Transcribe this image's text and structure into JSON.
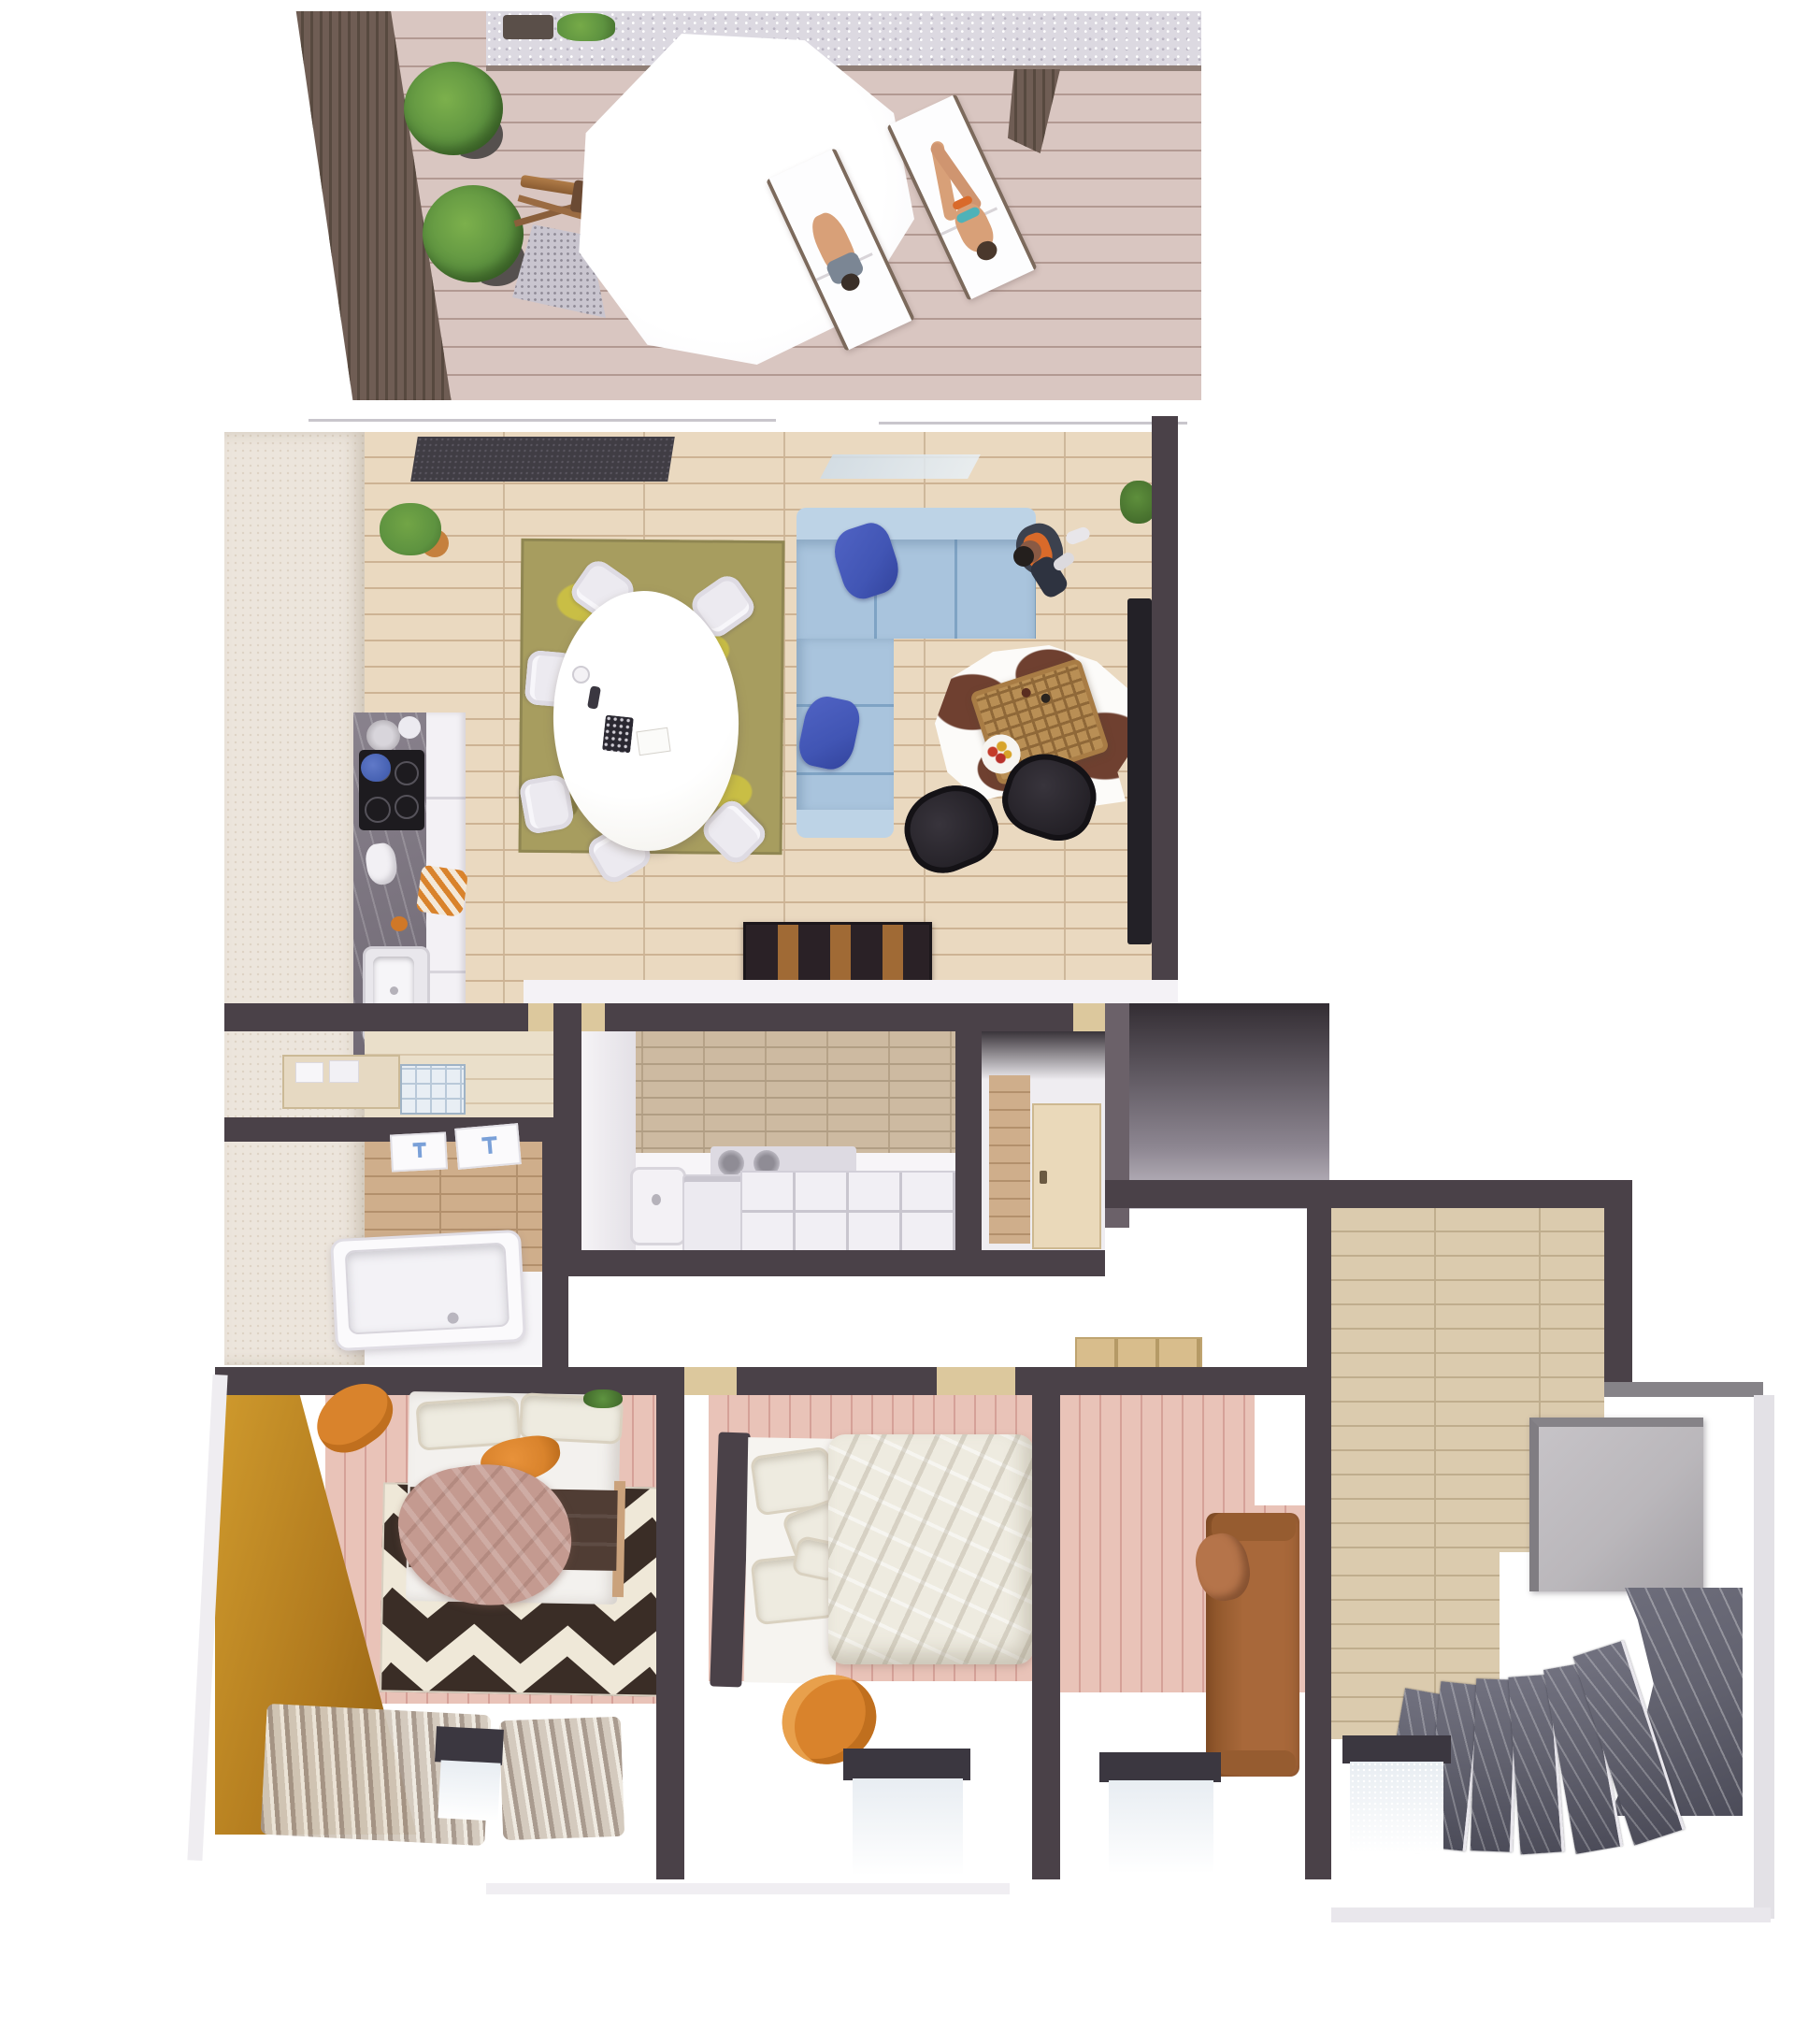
{
  "image_type": "3d-floor-plan-render",
  "view": "top-down dollhouse view, single apartment level, no visible text or labels",
  "scene": {
    "terrace": {
      "items": [
        "cantilever-umbrella",
        "sun-lounger-with-person",
        "sun-lounger-with-person",
        "topiary-plant",
        "topiary-plant",
        "hedge-planter",
        "gravel-border",
        "privacy-slat-wall",
        "wood-decking"
      ]
    },
    "living_room": {
      "items": [
        "doormat",
        "oval-dining-table",
        "dining-chairs-x6",
        "olive-area-rug",
        "potted-plant",
        "l-shaped-sofa",
        "blue-cushions-x2",
        "standing-person",
        "cowhide-rug",
        "wicker-coffee-table",
        "fruit-bowl",
        "black-lounge-chair-x2",
        "wall-tv",
        "low-bookshelf",
        "small-plant"
      ]
    },
    "kitchen": {
      "items": [
        "marble-counter",
        "cooktop",
        "sink",
        "checkered-towel",
        "dishes",
        "blue-pot"
      ]
    },
    "laundry_room": {
      "items": [
        "wash-basin",
        "washing-machine",
        "storage-cubbies",
        "counter",
        "closet-door"
      ]
    },
    "bathroom": {
      "items": [
        "bathtub",
        "towel-radiator",
        "towel-radiator",
        "wood-tile-wall"
      ]
    },
    "bedroom_left": {
      "items": [
        "double-bed",
        "pillows",
        "mauve-blanket",
        "orange-garment",
        "chevron-rug",
        "orange-armchair",
        "amber-wardrobe",
        "curtains",
        "window"
      ]
    },
    "bedroom_middle": {
      "items": [
        "double-bed-dark-headboard",
        "cream-duvet",
        "pillows-x4",
        "orange-armchair",
        "window"
      ]
    },
    "bedroom_right": {
      "items": [
        "leather-daybed",
        "cushion",
        "window",
        "doorway"
      ]
    },
    "entry_hall": {
      "items": [
        "wood-plank-floor",
        "gray-landing-pad",
        "closet-void"
      ]
    },
    "staircase": {
      "items": [
        "curved-marble-steps-x6",
        "marble-landing",
        "window"
      ]
    }
  },
  "palette": {
    "wall": "#4a4148",
    "wall-light": "#6b6169",
    "deck": "#d9c6c1",
    "deck-line": "#b29992",
    "slat": "#6f5d54",
    "slat-dark": "#57493f",
    "gravel": "#dcd9e1",
    "floor-living": "#ead9c0",
    "floor-living-line": "#cdb394",
    "tile-wood": "#cdbaa1",
    "tile-wood-line": "#b19e84",
    "bath-wood": "#cfae8b",
    "bath-wood-line": "#b3906c",
    "floor-pink": "#e9c3b8",
    "floor-pink-line": "#d5a198",
    "floor-hall": "#dbcbae",
    "floor-hall-line": "#bfad8d",
    "rug-olive": "#a79d5f",
    "rug-olive-spot": "#c9be45",
    "rug-olive-dark": "#857c42",
    "sofa": "#a9c4dd",
    "sofa-light": "#bdd3e6",
    "sofa-seam": "#7fa3c4",
    "pillow-blue": "#4155b4",
    "cowhide": "#6f4030",
    "wicker": "#b98f55",
    "wicker-line": "#8f6838",
    "chair-black": "#232026",
    "shelf-wood": "#a06a35",
    "marble": "#7b7480",
    "cabinet": "#f3f1f5",
    "orange": "#d9832c",
    "orange-dark": "#c06f1e",
    "amber": "#b17a1e",
    "amber-light": "#cf9a2d",
    "mauve": "#c49a90",
    "blanket-brown": "#503d34",
    "bed-cream": "#eeebe0",
    "daybed": "#a8683a",
    "daybed-dark": "#8a5328",
    "step": "#62626f",
    "step-dark": "#4c4c59",
    "elevator": "#bab7bb",
    "elevator-edge": "#868388",
    "curtain": "#d2c8bb",
    "curtain-line": "#a5968a",
    "glass": "#e8edf2",
    "frame-dark": "#3b3740",
    "green": "#5e9340",
    "green-dark": "#456f2d",
    "pot": "#c5803d",
    "skin": "#d8a078",
    "doormat": "#403d44",
    "door-cream": "#ead9ba",
    "threshold": "#dcc89d",
    "chevron-dark": "#3a2d26",
    "chevron-cream": "#efe8d8"
  }
}
